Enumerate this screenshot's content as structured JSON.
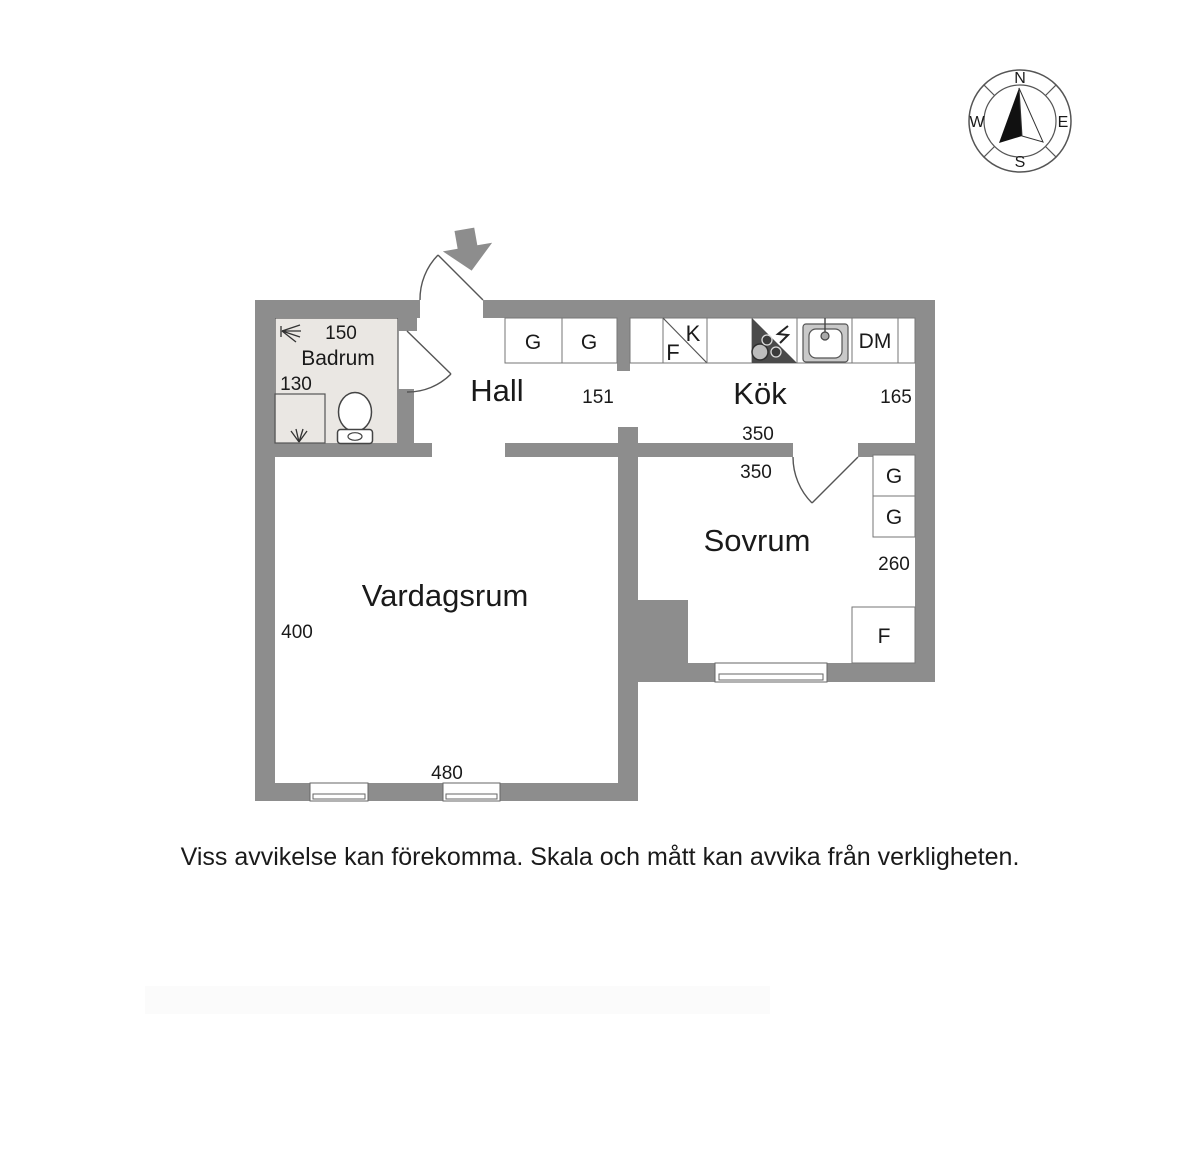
{
  "plan": {
    "rooms": {
      "hall": "Hall",
      "kitchen": "Kök",
      "bedroom": "Sovrum",
      "living_room": "Vardagsrum",
      "bathroom": "Badrum"
    },
    "dimensions": {
      "bathroom_width": "150",
      "bathroom_depth": "130",
      "hall_width": "151",
      "kitchen_width": "350",
      "kitchen_depth": "165",
      "bedroom_width": "350",
      "bedroom_depth": "260",
      "living_room_depth": "400",
      "living_room_width": "480"
    },
    "fixtures": {
      "hall_wardrobe_1": "G",
      "hall_wardrobe_2": "G",
      "fridge": "K",
      "freezer": "F",
      "dishwasher": "DM",
      "bedroom_wardrobe_1": "G",
      "bedroom_wardrobe_2": "G",
      "bedroom_closet": "F"
    },
    "compass": {
      "north": "N",
      "east": "E",
      "south": "S",
      "west": "W"
    }
  },
  "footer": {
    "disclaimer": "Viss avvikelse kan förekomma. Skala och mått kan avvika från verkligheten."
  },
  "colors": {
    "wall": "#8d8d8d",
    "bathroom_floor": "#eae7e3",
    "stove": "#4a4a4a",
    "outline": "#555555",
    "text": "#1a1a1a"
  }
}
